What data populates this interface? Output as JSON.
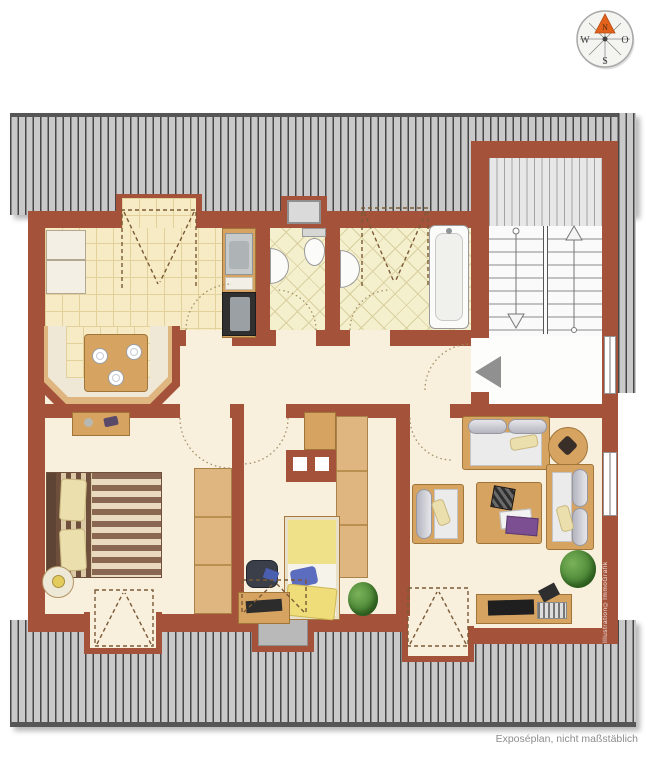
{
  "compass": {
    "north_label": "N",
    "west_label": "W",
    "east_label": "O",
    "south_label": "S"
  },
  "caption": "Exposéplan, nicht maßstäblich",
  "watermark": "Illustration©ImmoGrafik",
  "colors": {
    "wall": "#a4523a",
    "roof_hatch": "#c9c9c9",
    "roof_hatch_line": "#474747",
    "apartment_floor": "#f8efdd",
    "kitchen_tile": "#f6ebc4",
    "bath_tile": "#f4efcd",
    "north_marker": "#e2621b",
    "entrance_arrow": "#909090",
    "furniture_wood": "#d6a361"
  },
  "icons": {
    "north_marker": "triangle-up",
    "entrance_arrow": "triangle-left",
    "stairs_up_arrow": "arrow-up",
    "stairs_down_arrow": "arrow-down",
    "door_swing": "dotted-quarter-arc",
    "roof_window": "dashed-rect-v"
  }
}
